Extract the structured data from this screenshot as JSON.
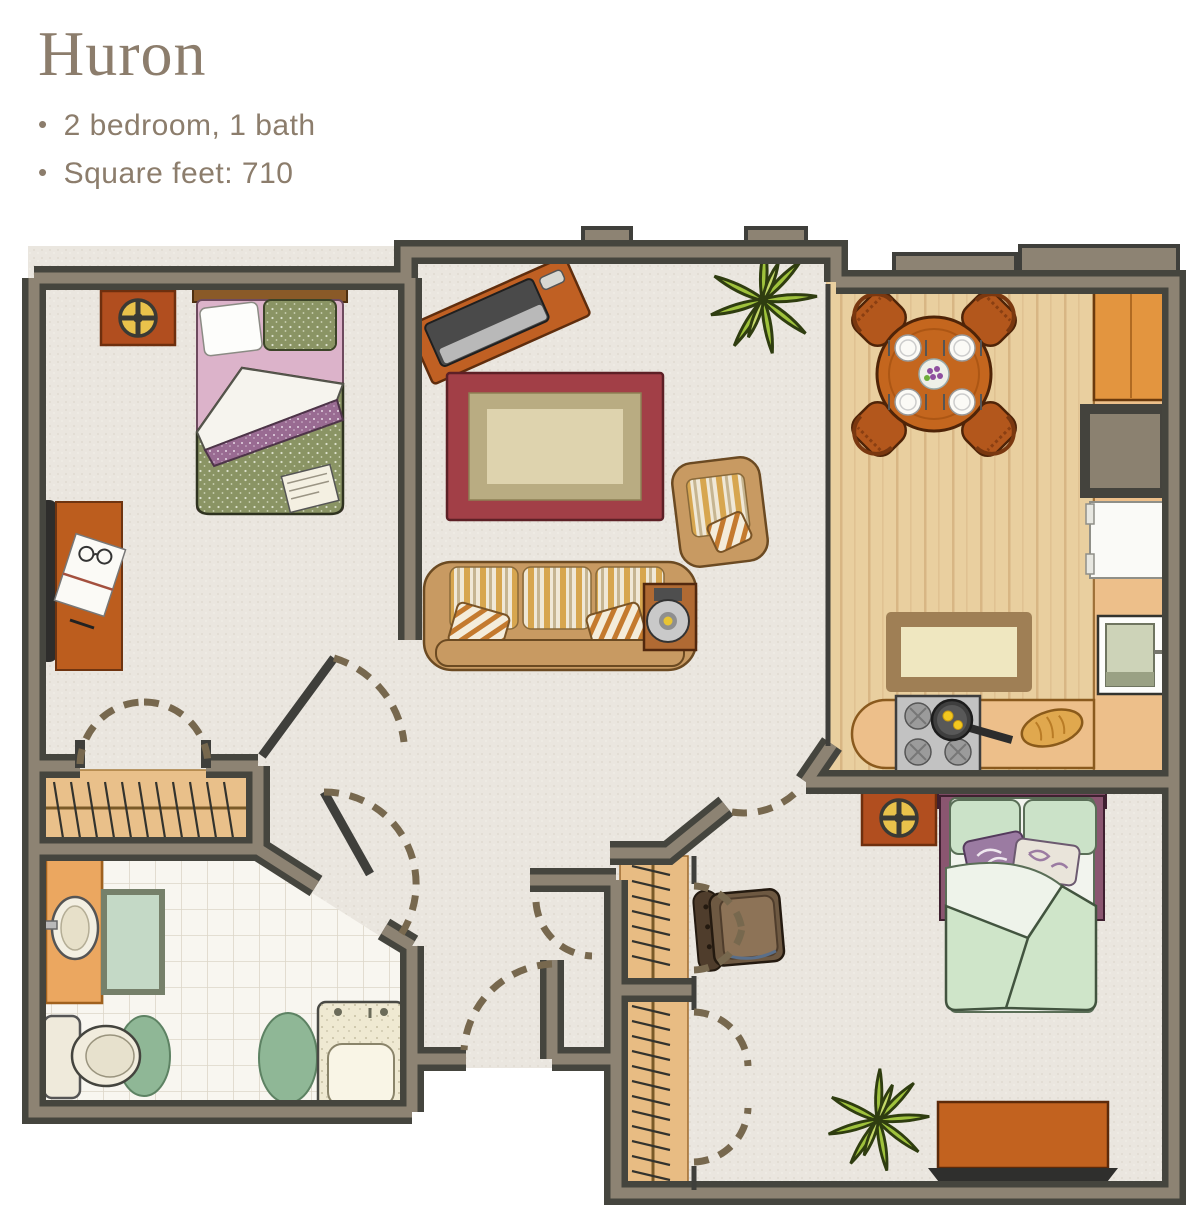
{
  "header": {
    "title": "Huron",
    "bullet_char": "•",
    "bullets": [
      {
        "text": "2 bedroom, 1 bath"
      },
      {
        "text": "Square feet: 710"
      }
    ]
  },
  "unit": {
    "name": "Huron",
    "bedrooms": 2,
    "bathrooms": 1,
    "square_feet": 710
  },
  "palette": {
    "text_brown": "#8c7d6c",
    "wall_dark": "#45453e",
    "wall_tan": "#8d8373",
    "carpet": "#eae6df",
    "wood_floor": "#e9cf9f",
    "tile": "#f8f6f0",
    "furniture_wood": "#c0601f",
    "rug_red": "#a23f47",
    "rug_olive": "#b9ac82",
    "rug_cream": "#ded3ae",
    "bed1_green": "#8a9464",
    "bed1_purple": "#996b92",
    "bed2_mint": "#cfe3cb",
    "bed2_plum": "#7c4a63",
    "sofa_tan": "#c89a62",
    "plant_green": "#9fc23c",
    "bath_green": "#8fb796",
    "door_dash": "#77684e"
  },
  "floorplan": {
    "rooms": [
      {
        "name": "bedroom-1",
        "furniture": [
          "double-bed",
          "nightstand-with-clock",
          "desk",
          "desk-chair",
          "bifold-closet"
        ]
      },
      {
        "name": "living-room",
        "furniture": [
          "tv-console",
          "area-rug",
          "sofa",
          "armchair",
          "side-table-record-player",
          "potted-plant"
        ]
      },
      {
        "name": "kitchen-dining",
        "furniture": [
          "round-dining-table",
          "four-chairs",
          "place-settings",
          "stove-with-pan",
          "bread-loaf",
          "refrigerator",
          "pantry-niche",
          "tall-cabinet",
          "oven",
          "kitchen-rug"
        ]
      },
      {
        "name": "bathroom",
        "furniture": [
          "vanity-sink",
          "bath-mat",
          "toilet",
          "oval-rugs",
          "walk-in-tub"
        ]
      },
      {
        "name": "bedroom-2",
        "furniture": [
          "double-bed",
          "nightstand-with-clock",
          "leather-armchair",
          "closet-upper",
          "closet-lower",
          "dresser",
          "potted-plant"
        ]
      },
      {
        "name": "entry-hall",
        "furniture": [
          "entry-door-swings"
        ]
      }
    ]
  }
}
